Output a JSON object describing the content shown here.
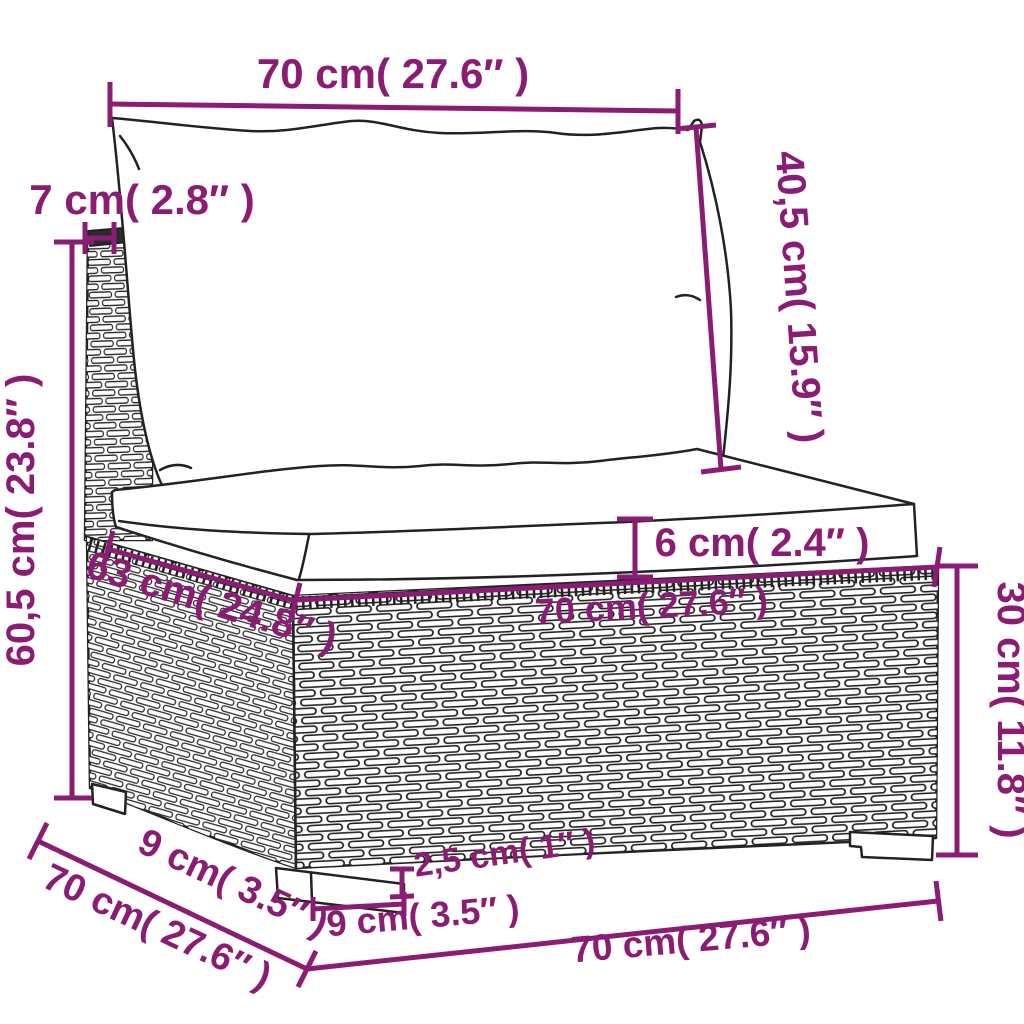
{
  "diagram": {
    "title": "sofa-section-dimension-diagram",
    "background": "#ffffff",
    "accent_color": "#8b1c73",
    "line_color": "#222222",
    "labels": {
      "back_width": "70 cm( 27.6″ )",
      "back_cushion_height": "40,5 cm( 15.9″ )",
      "frame_top_depth": "7 cm( 2.8″ )",
      "total_height": "60,5 cm( 23.8″ )",
      "seat_depth": "63 cm( 24.8″ )",
      "cushion_thickness": "6 cm( 2.4″ )",
      "seat_width": "70 cm( 27.6″ )",
      "base_height": "30 cm( 11.8″ )",
      "leg_depth": "9 cm( 3.5″ )",
      "total_depth": "70 cm( 27.6″ )",
      "leg_height": "2,5 cm( 1″ )",
      "leg_width": "9 cm( 3.5″ )",
      "total_width": "70 cm( 27.6″ )"
    }
  }
}
